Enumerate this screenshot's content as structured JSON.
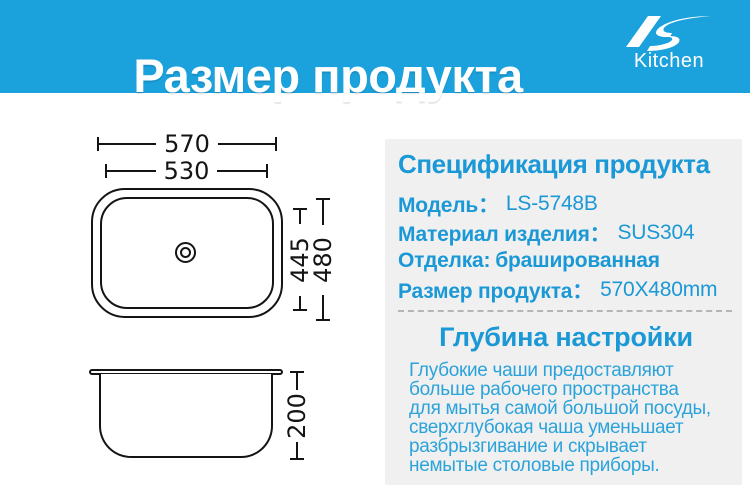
{
  "header": {
    "title": "Размер продукта",
    "brand": "Kitchen",
    "logo_icon": "ls-swoosh-icon"
  },
  "colors": {
    "accent_blue": "#1ba1dc",
    "spec_text_blue": "#1b98d6",
    "paragraph_blue": "#2ba3da",
    "panel_gray": "#f0f0f0",
    "drawing_line": "#141414"
  },
  "drawing": {
    "dims": {
      "outer_width": "570",
      "inner_width": "530",
      "inner_height": "445",
      "outer_height": "480",
      "depth": "200"
    }
  },
  "spec": {
    "title": "Спецификация продукта",
    "rows": [
      {
        "label": "Модель：",
        "value": "LS-5748B"
      },
      {
        "label": "Материал изделия：",
        "value": "SUS304"
      },
      {
        "label": "Отделка:",
        "value": "брашированная"
      },
      {
        "label": "Размер продукта：",
        "value": "570X480mm"
      }
    ]
  },
  "depth": {
    "title": "Глубина настройки",
    "lines": [
      "Глубокие чаши предоставляют",
      "больше рабочего пространства",
      "для мытья самой большой посуды,",
      "сверхглубокая чаша уменьшает",
      "разбрызгивание и скрывает",
      "немытые столовые приборы."
    ]
  }
}
